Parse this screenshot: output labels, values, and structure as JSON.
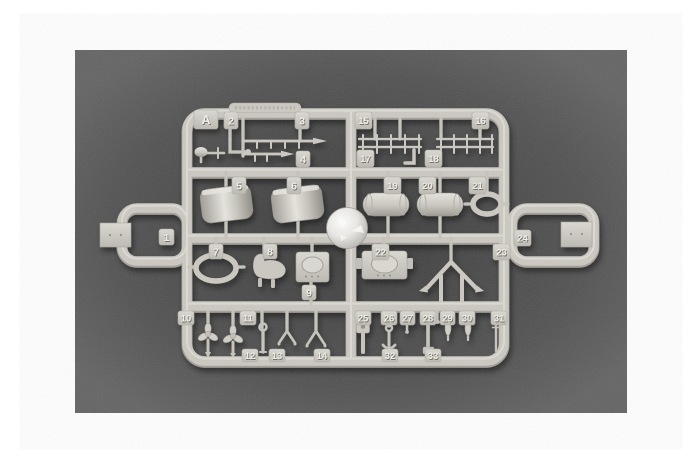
{
  "scene": {
    "type": "product photograph",
    "subject": "Plastic model kit sprue (runner) with numbered part tabs on dark gray background",
    "canvas_background": "#ffffff",
    "photo_background": "#636363",
    "photo_shadow": "#373737",
    "plastic_color": "#cbc9c1",
    "plastic_highlight": "#e6e4dd",
    "plastic_shadow": "#a39f97"
  },
  "sprue": {
    "frame_letter": "A",
    "tags": [
      {
        "label": "A",
        "x": 194,
        "y": 110,
        "w": 24,
        "h": 19,
        "fs": 12.5
      },
      {
        "label": "2",
        "x": 224,
        "y": 112,
        "w": 14,
        "h": 17
      },
      {
        "label": "3",
        "x": 295,
        "y": 112,
        "w": 14,
        "h": 17
      },
      {
        "label": "15",
        "x": 355,
        "y": 112,
        "w": 17,
        "h": 17
      },
      {
        "label": "16",
        "x": 472,
        "y": 112,
        "w": 17,
        "h": 17
      },
      {
        "label": "4",
        "x": 296,
        "y": 151,
        "w": 14,
        "h": 16
      },
      {
        "label": "17",
        "x": 357,
        "y": 150,
        "w": 17,
        "h": 17
      },
      {
        "label": "18",
        "x": 425,
        "y": 150,
        "w": 17,
        "h": 17
      },
      {
        "label": "5",
        "x": 232,
        "y": 177,
        "w": 14,
        "h": 17
      },
      {
        "label": "6",
        "x": 287,
        "y": 177,
        "w": 14,
        "h": 17
      },
      {
        "label": "19",
        "x": 384,
        "y": 177,
        "w": 17,
        "h": 17
      },
      {
        "label": "20",
        "x": 419,
        "y": 177,
        "w": 17,
        "h": 17
      },
      {
        "label": "21",
        "x": 469,
        "y": 177,
        "w": 17,
        "h": 17
      },
      {
        "label": "1",
        "x": 159,
        "y": 229,
        "w": 15,
        "h": 16
      },
      {
        "label": "7",
        "x": 209,
        "y": 244,
        "w": 14,
        "h": 15
      },
      {
        "label": "8",
        "x": 263,
        "y": 244,
        "w": 14,
        "h": 15
      },
      {
        "label": "22",
        "x": 372,
        "y": 244,
        "w": 17,
        "h": 16
      },
      {
        "label": "23",
        "x": 493,
        "y": 244,
        "w": 17,
        "h": 16
      },
      {
        "label": "24",
        "x": 514,
        "y": 230,
        "w": 17,
        "h": 16
      },
      {
        "label": "9",
        "x": 302,
        "y": 285,
        "w": 14,
        "h": 15
      },
      {
        "label": "10",
        "x": 178,
        "y": 311,
        "w": 16,
        "h": 14
      },
      {
        "label": "11",
        "x": 240,
        "y": 311,
        "w": 16,
        "h": 14
      },
      {
        "label": "25",
        "x": 355,
        "y": 311,
        "w": 16,
        "h": 14
      },
      {
        "label": "26",
        "x": 381,
        "y": 311,
        "w": 16,
        "h": 14
      },
      {
        "label": "27",
        "x": 400,
        "y": 311,
        "w": 15,
        "h": 14
      },
      {
        "label": "28",
        "x": 420,
        "y": 311,
        "w": 16,
        "h": 14
      },
      {
        "label": "29",
        "x": 440,
        "y": 311,
        "w": 15,
        "h": 14
      },
      {
        "label": "30",
        "x": 459,
        "y": 311,
        "w": 16,
        "h": 14
      },
      {
        "label": "31",
        "x": 491,
        "y": 311,
        "w": 16,
        "h": 14
      },
      {
        "label": "12",
        "x": 242,
        "y": 349,
        "w": 16,
        "h": 13
      },
      {
        "label": "13",
        "x": 269,
        "y": 349,
        "w": 16,
        "h": 13
      },
      {
        "label": "14",
        "x": 314,
        "y": 349,
        "w": 16,
        "h": 13
      },
      {
        "label": "32",
        "x": 382,
        "y": 349,
        "w": 16,
        "h": 13
      },
      {
        "label": "33",
        "x": 425,
        "y": 349,
        "w": 16,
        "h": 13
      }
    ]
  }
}
